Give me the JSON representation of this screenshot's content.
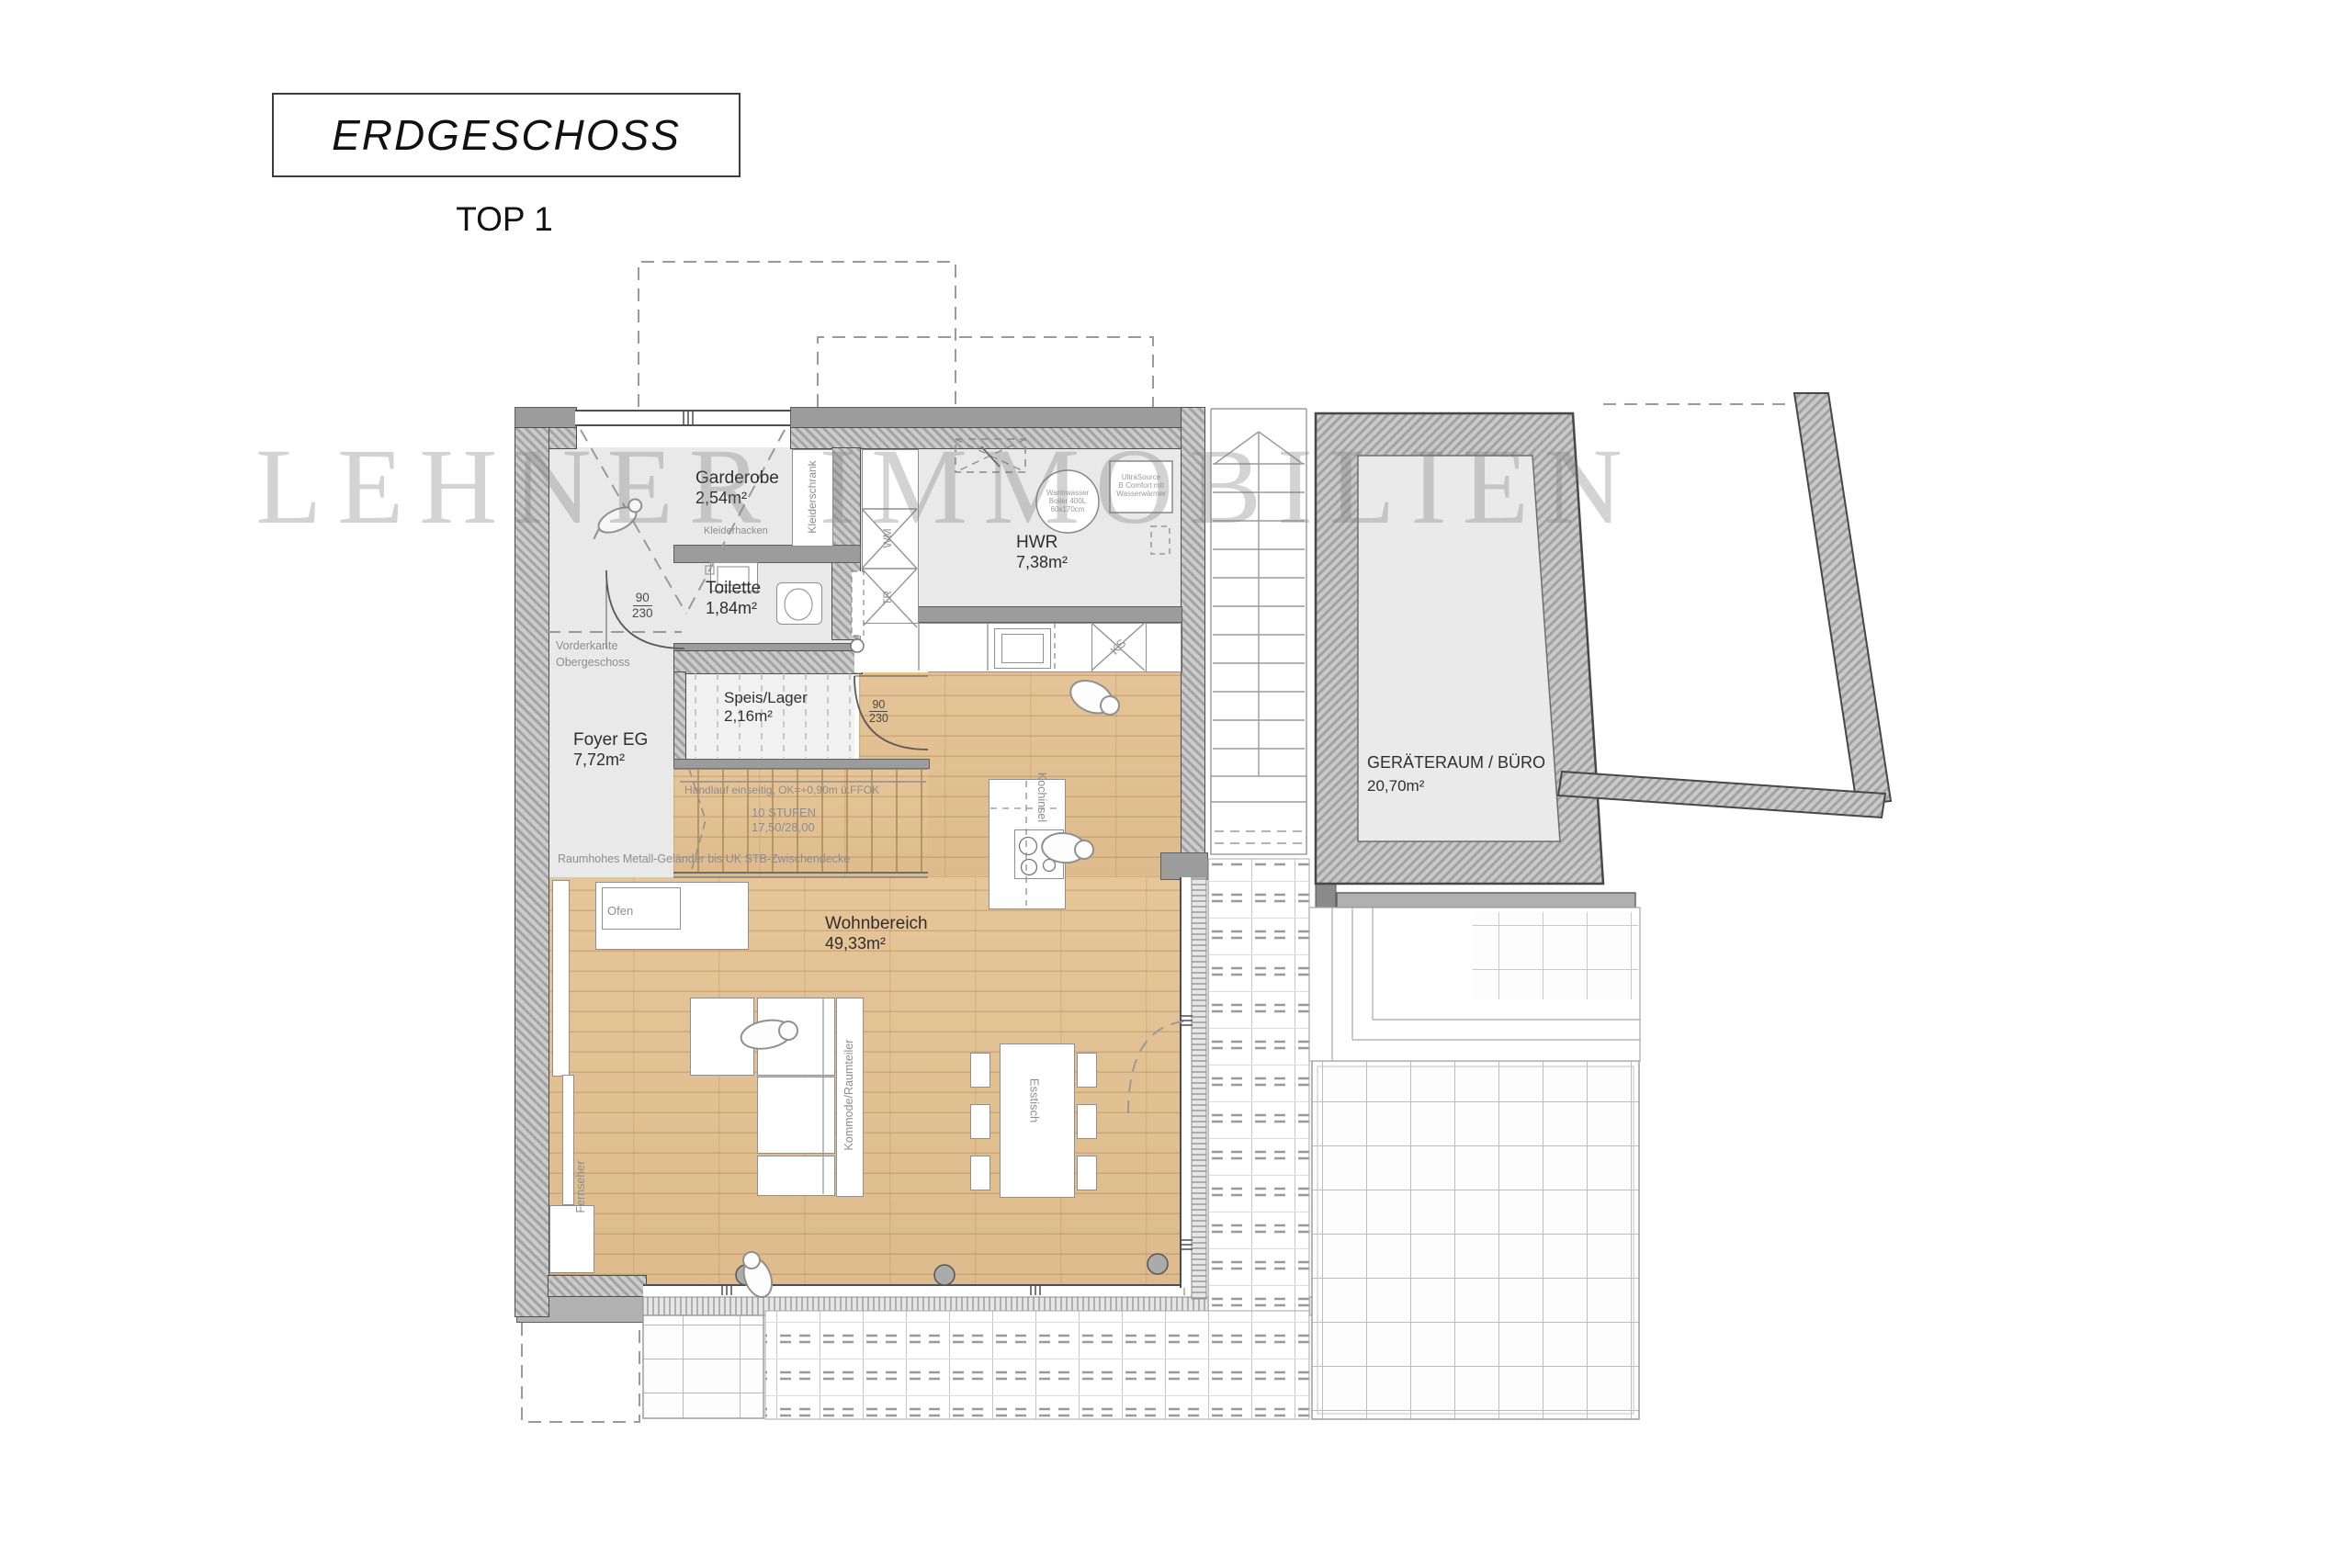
{
  "title": {
    "main": "ERDGESCHOSS",
    "sub": "TOP 1"
  },
  "watermark": "LEHNER IMMOBILIEN",
  "rooms": {
    "garderobe": {
      "name": "Garderobe",
      "area": "2,54m²"
    },
    "toilette": {
      "name": "Toilette",
      "area": "1,84m²"
    },
    "hwr": {
      "name": "HWR",
      "area": "7,38m²"
    },
    "speis": {
      "name": "Speis/Lager",
      "area": "2,16m²"
    },
    "foyer": {
      "name": "Foyer EG",
      "area": "7,72m²"
    },
    "wohnbereich": {
      "name": "Wohnbereich",
      "area": "49,33m²"
    },
    "geraeteraum": {
      "name": "GERÄTERAUM / BÜRO",
      "area": "20,70m²"
    }
  },
  "furniture": {
    "kleiderschrank": "Kleiderschrank",
    "kleiderhacken": "Kleiderhacken",
    "waschmaschine": "WM",
    "trockner": "TR",
    "kuehlschrank": "KS",
    "kochinsel": "Kochinsel",
    "esstisch": "Esstisch",
    "ofen": "Ofen",
    "fernseher": "Fernseher",
    "kommode": "Kommode/Raumteiler",
    "boiler_l1": "Warmwasser",
    "boiler_l2": "Boiler 400L",
    "boiler_l3": "60x170cm",
    "ultra_l1": "UltraSource",
    "ultra_l2": "B Comfort mit",
    "ultra_l3": "Wasserwärmer"
  },
  "annotations": {
    "vorderkante_l1": "Vorderkante",
    "vorderkante_l2": "Obergeschoss",
    "handlauf": "Handlauf einseitig, OK=+0,90m ü.FFOK",
    "stufen_l1": "10 STUFEN",
    "stufen_l2": "17,50/28,00",
    "gelaender": "Raumhohes Metall-Geländer bis UK STB-Zwischendecke",
    "door_width": "90",
    "door_height": "230"
  },
  "colors": {
    "wood": "#e4c191",
    "wall": "#9c9c9c",
    "room": "#e9e9e9",
    "line": "#4e4e4e"
  }
}
